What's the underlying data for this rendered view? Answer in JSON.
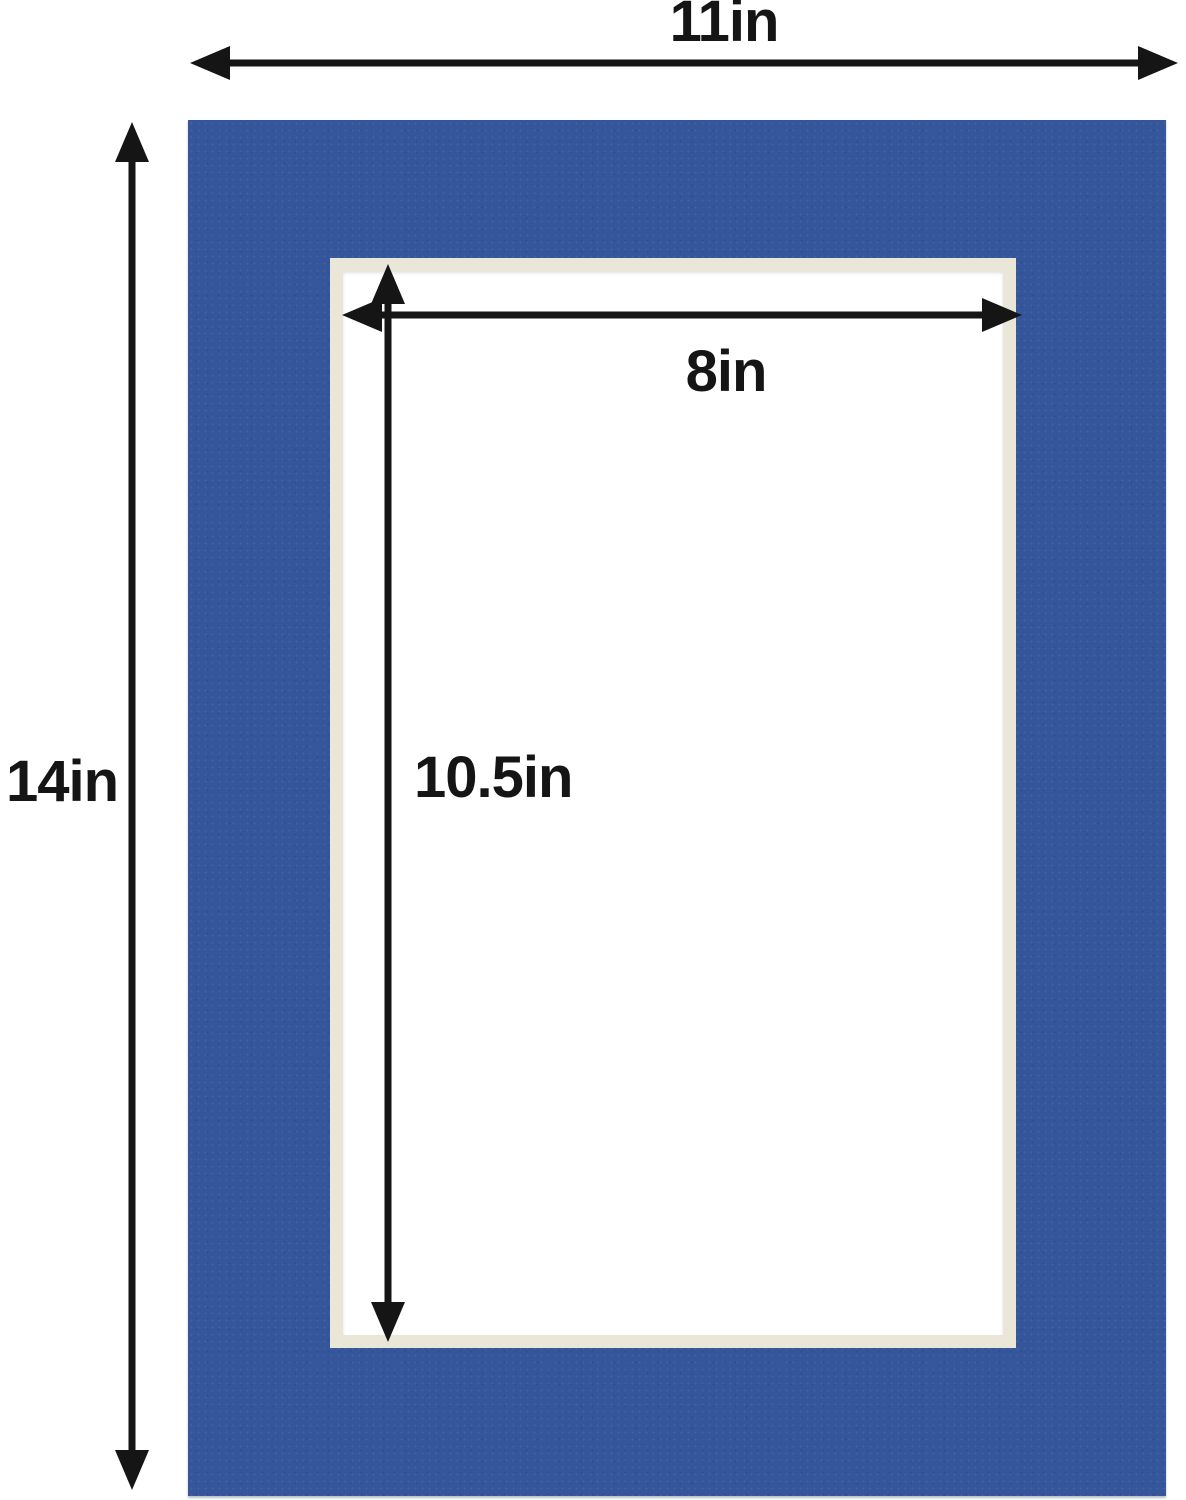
{
  "diagram": {
    "labels": {
      "outer_width": "11in",
      "outer_height": "14in",
      "opening_width": "8in",
      "opening_height": "10.5in"
    },
    "colors": {
      "background": "#ffffff",
      "mat": "#35569b",
      "bevel": "#eae6d8",
      "opening": "#ffffff",
      "arrow": "#151515",
      "text": "#151515"
    }
  }
}
